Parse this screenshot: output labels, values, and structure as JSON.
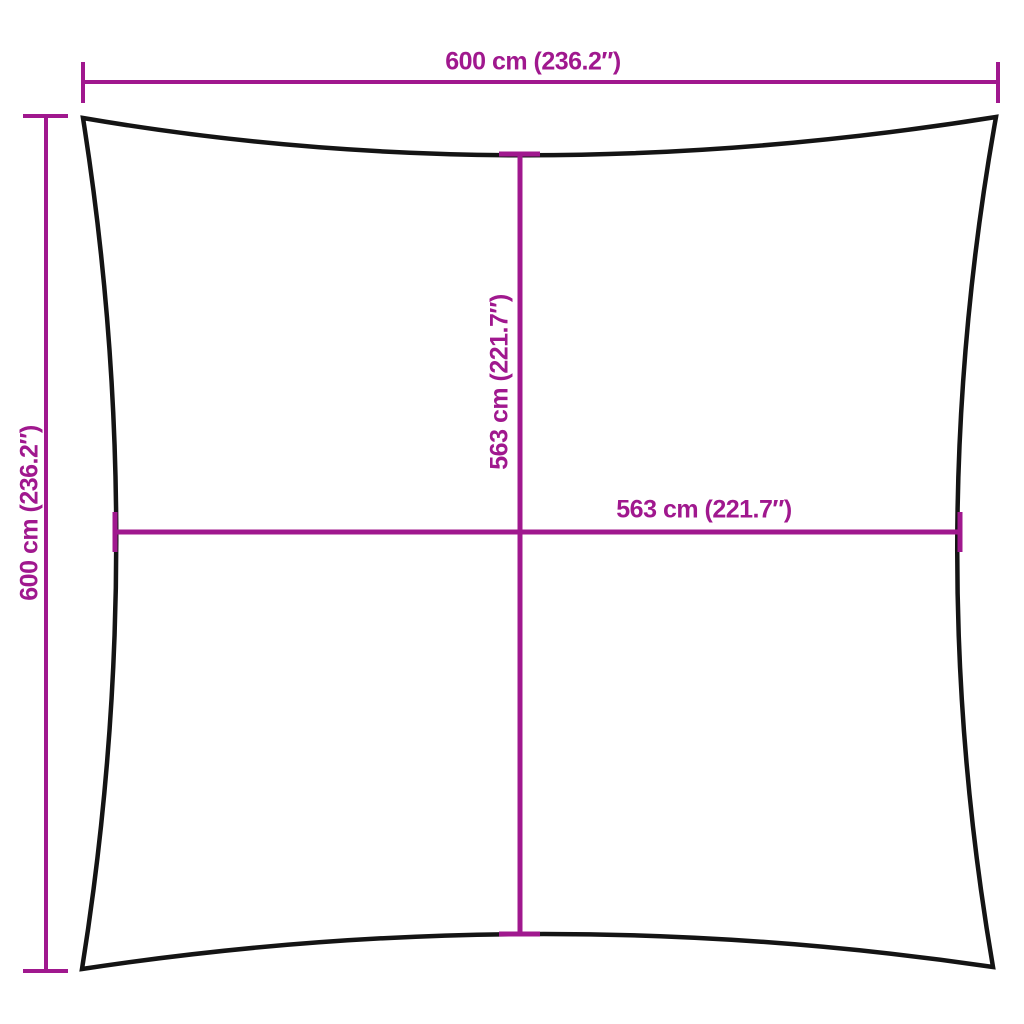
{
  "diagram": {
    "kind": "product-dimension-diagram",
    "subject": "square shade sail outline with concave edges",
    "labels": {
      "top_width": "600 cm (236.2″)",
      "left_height": "600 cm (236.2″)",
      "inner_height": "563 cm (221.7″)",
      "inner_width": "563 cm (221.7″)"
    },
    "dimensions": [
      {
        "measure": "overall width (top)",
        "cm": 600,
        "inches": 236.2
      },
      {
        "measure": "overall height (left)",
        "cm": 600,
        "inches": 236.2
      },
      {
        "measure": "midpoint height (center vertical)",
        "cm": 563,
        "inches": 221.7
      },
      {
        "measure": "midpoint width (center horizontal)",
        "cm": 563,
        "inches": 221.7
      }
    ],
    "colors": {
      "dimension": "#a0188e",
      "outline": "#141414",
      "background": "#ffffff"
    }
  }
}
